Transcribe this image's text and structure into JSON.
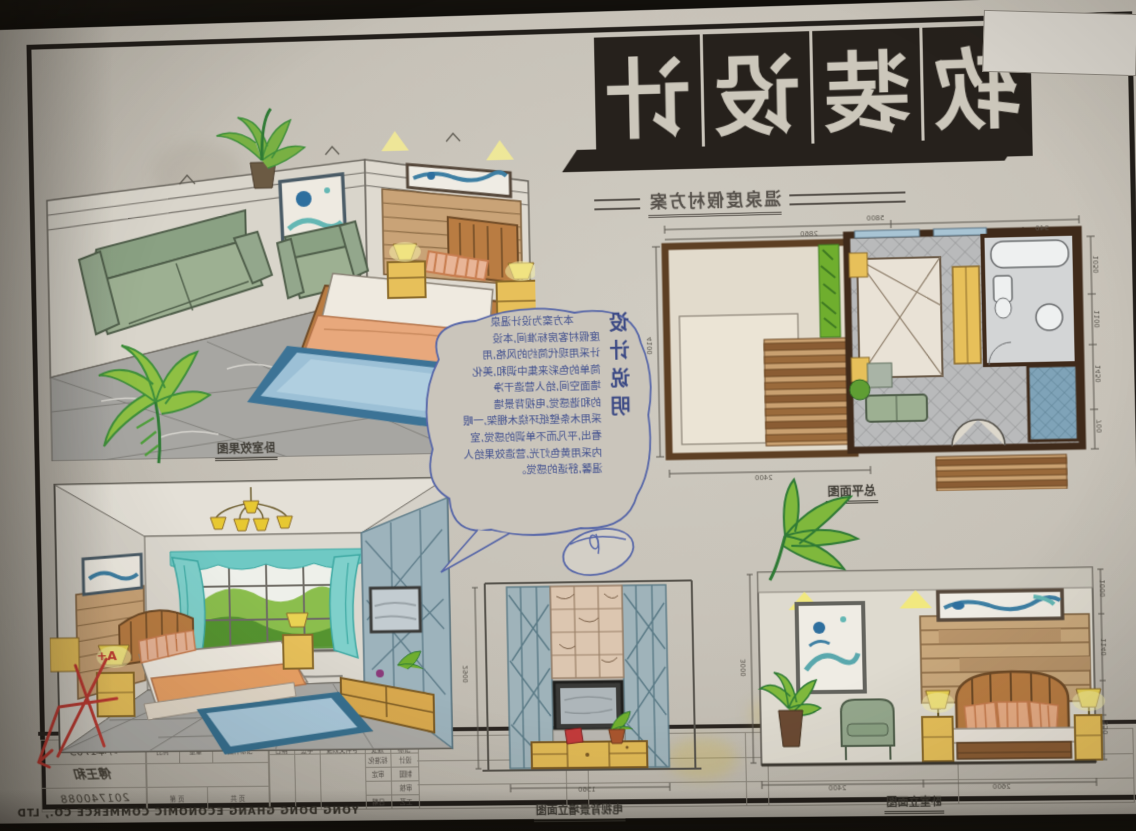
{
  "board": {
    "main_title": "软装设计",
    "logo_chars": [
      "软",
      "装",
      "设",
      "计"
    ],
    "subtitle": "温泉度假村方案",
    "design_notes": {
      "heading": "设计说明",
      "lines": [
        "本方案为设计温泉",
        "度假村客房标准间,本设",
        "计采用现代简约的风格,用",
        "简单的色彩来集中调和,美化",
        "墙面空间,给人营造干净",
        "的和谐感觉,电视背景墙",
        "采用木条壁纸环绕木棚架,一眼",
        "看出,平凡而不单调的感觉,室",
        "内采用黄色灯光,营造效果给人",
        "温馨,舒适的感觉。"
      ]
    },
    "labels": {
      "perspective_top": "卧室效果图",
      "floor_plan": "总平面图",
      "tv_wall_elevation": "电视背景墙立面图",
      "bedroom_elevation": "卧室立面图"
    },
    "grade_mark": "A+",
    "dimensions": {
      "floor_plan": {
        "top_total": "5800",
        "top_left": "2860",
        "top_right": "940",
        "left": "4100",
        "bottom": "2400",
        "right_1": "1050",
        "right_2": "1100",
        "right_3": "1450",
        "right_4": "700"
      },
      "tv_wall": {
        "height": "2900",
        "width": "1560"
      },
      "bedroom": {
        "height": "3000",
        "width_left": "2400",
        "width_right": "2600",
        "right_1": "1000",
        "right_2": "1140",
        "right_3": "350"
      }
    },
    "title_block": {
      "class_no": "环本1703",
      "name": "傅王和",
      "student_id": "201740088",
      "header": [
        "日期",
        "签字",
        "更改文件号",
        "处数",
        "标记"
      ],
      "col_mid": [
        "标准化",
        "审定",
        "日期"
      ],
      "col_left": [
        "设计",
        "制图",
        "审核",
        "工艺"
      ],
      "marks": [
        "比例",
        "重量",
        "图样标记"
      ],
      "pages": [
        "第 页",
        "共 页"
      ],
      "footer": "YONG DONG GHANG ECONOMIC COMMERCE CO., LTD"
    },
    "colors": {
      "paper": "#c8c3b9",
      "ink": "#3c3a36",
      "black_fill": "#26211c",
      "pen_blue": "#4c5ca6",
      "red_pen": "#c03a32",
      "sofa_green": "#9ab08f",
      "wood_tan": "#c99e6a",
      "furniture_yellow": "#e5bd55",
      "bedding_orange": "#e8a87c",
      "rug_blue": "#9cc0d6",
      "curtain_teal": "#6fc9c4",
      "tile_gray": "#a3a2a0",
      "lattice_blue": "#9fb3ba",
      "plant_green": "#6fae2e",
      "deck_brown": "#8a5c33"
    }
  }
}
